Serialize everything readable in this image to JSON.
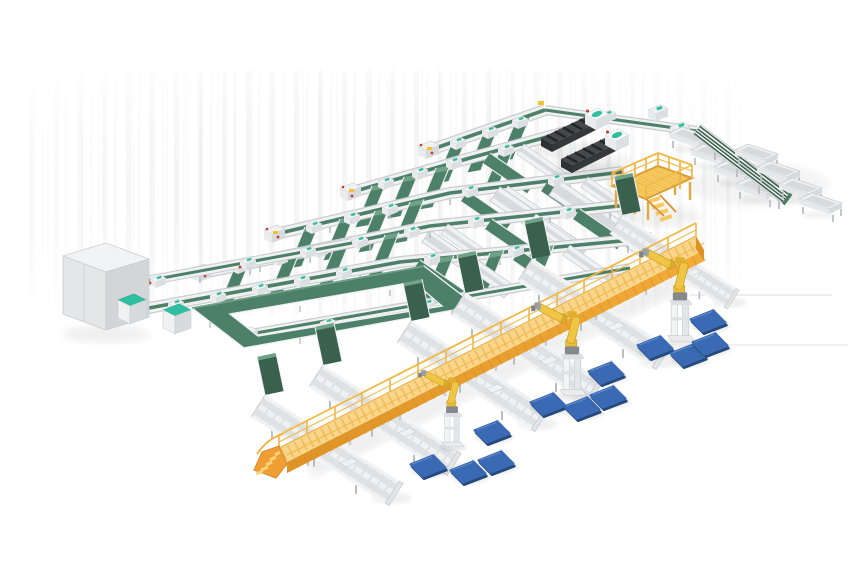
{
  "scene": {
    "description": "Isometric 3D render of an automated conveyor sorting line with elevated walkway and robotic palletizing",
    "regions": {
      "sorting_grid": {
        "label": "conveyor sorting grid",
        "rows": 6,
        "transfer_ramps": 22,
        "cross_bands": 11
      },
      "processing_machines": {
        "label": "dark processing machines",
        "count": 2
      },
      "operator_platform": {
        "label": "yellow operator platform with stairs",
        "count": 1
      },
      "outfeed_spur": {
        "label": "outfeed spur conveyor",
        "trays": 8
      },
      "loop_conveyor": {
        "label": "green loop buffer conveyor",
        "count": 1
      },
      "cabinets": {
        "label": "equipment cabinets",
        "large_gray": 1,
        "teal_top": 2
      },
      "elevated_walkway": {
        "label": "yellow elevated walkway with end ramp",
        "count": 1,
        "support_legs": 9
      },
      "palletizing_robots": {
        "label": "yellow palletizing robots",
        "count": 3
      },
      "cross_conveyors": {
        "label": "white cross roller conveyors",
        "count": 6
      },
      "pallets": {
        "label": "blue pallets on floor",
        "count": 12
      }
    }
  },
  "colors": {
    "background": "#ffffff",
    "belt_green": "#4d8068",
    "belt_green_dark": "#3a604e",
    "belt_green_light": "#6fa286",
    "frame_white": "#f0f1f2",
    "frame_edge": "#c9cdd1",
    "frame_mid": "#dfe1e4",
    "frame_deep": "#b9bdc0",
    "teal_accent": "#2fbfa0",
    "walkway_yellow": "#f6c95f",
    "walkway_deck": "#fbd689",
    "walkway_side": "#f0a936",
    "walkway_dark": "#da9227",
    "walkway_rail": "#f1b23e",
    "robot_yellow": "#f0c544",
    "robot_joint": "#c49a22",
    "machine_body": "#44484b",
    "machine_black": "#232527",
    "pallet_blue": "#3a6ab3",
    "pallet_blue_dark": "#26497e",
    "pallet_blue_light": "#6d95d6",
    "accent_red": "#c23a28",
    "accent_yellow": "#f2c12f"
  }
}
